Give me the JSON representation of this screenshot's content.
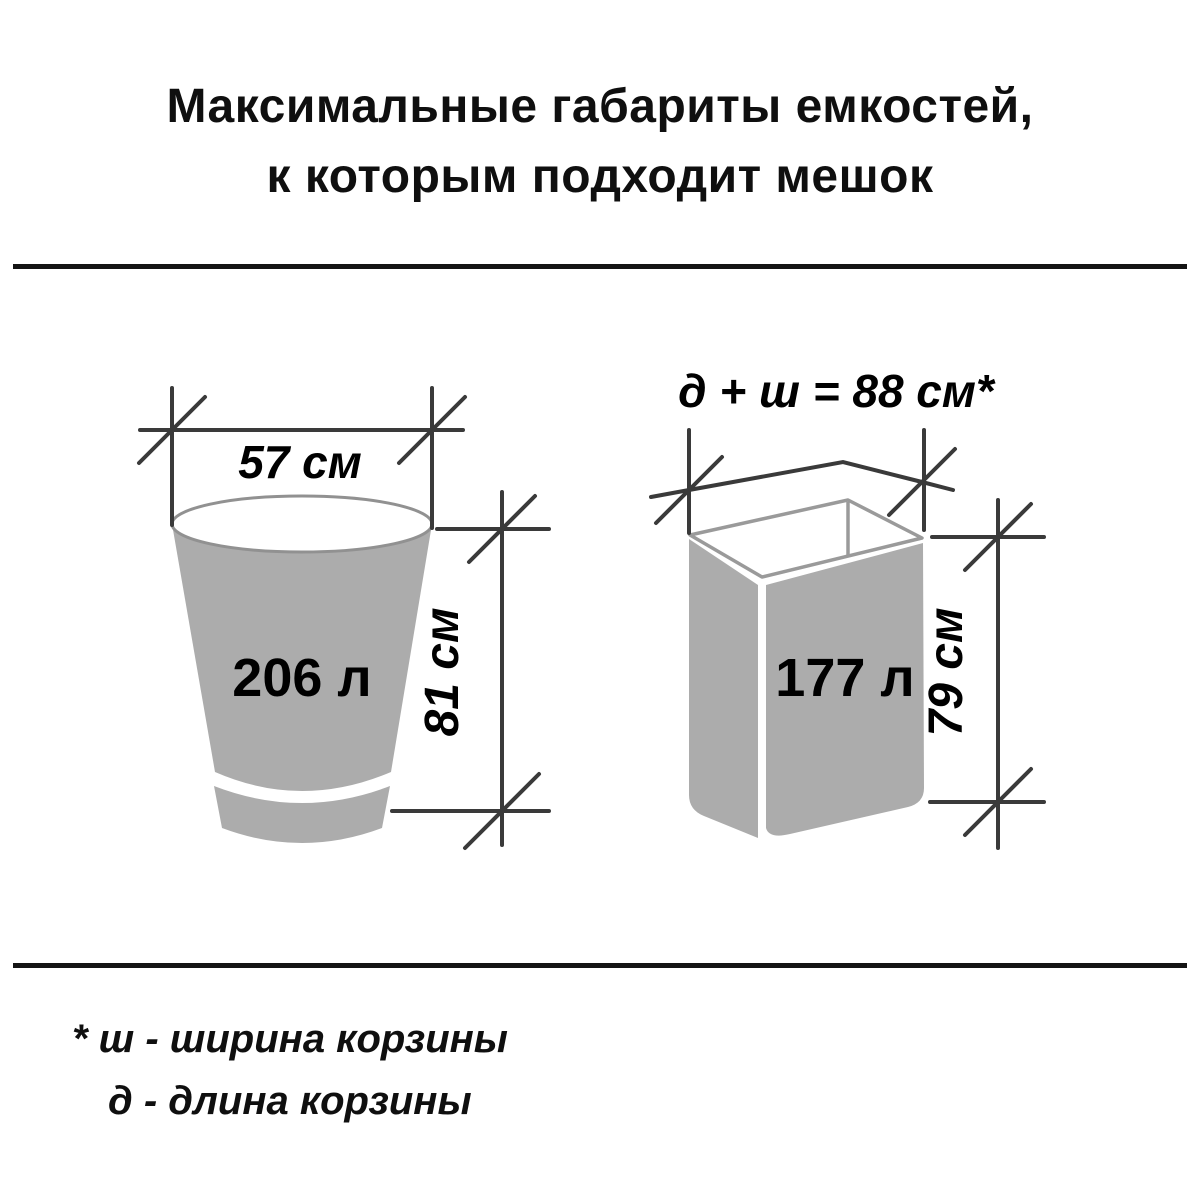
{
  "title": {
    "line1": "Максимальные габариты емкостей,",
    "line2": "к которым подходит мешок"
  },
  "figures": {
    "bucket": {
      "width_label": "57 см",
      "height_label": "81 см",
      "volume_label": "206 л",
      "width_cm": 57,
      "height_cm": 81,
      "volume_l": 206
    },
    "basket": {
      "top_label": "д + ш = 88 см*",
      "height_label": "79 см",
      "volume_label": "177 л",
      "length_plus_width_cm": 88,
      "height_cm": 79,
      "volume_l": 177
    }
  },
  "footnote": {
    "line1": "* ш - ширина корзины",
    "line2": "д  - длина корзины"
  },
  "colors": {
    "background": "#ffffff",
    "figure_fill": "#acacac",
    "figure_outline": "#919191",
    "dimension_line": "#3a3a3a",
    "divider": "#141414",
    "text": "#000000"
  }
}
